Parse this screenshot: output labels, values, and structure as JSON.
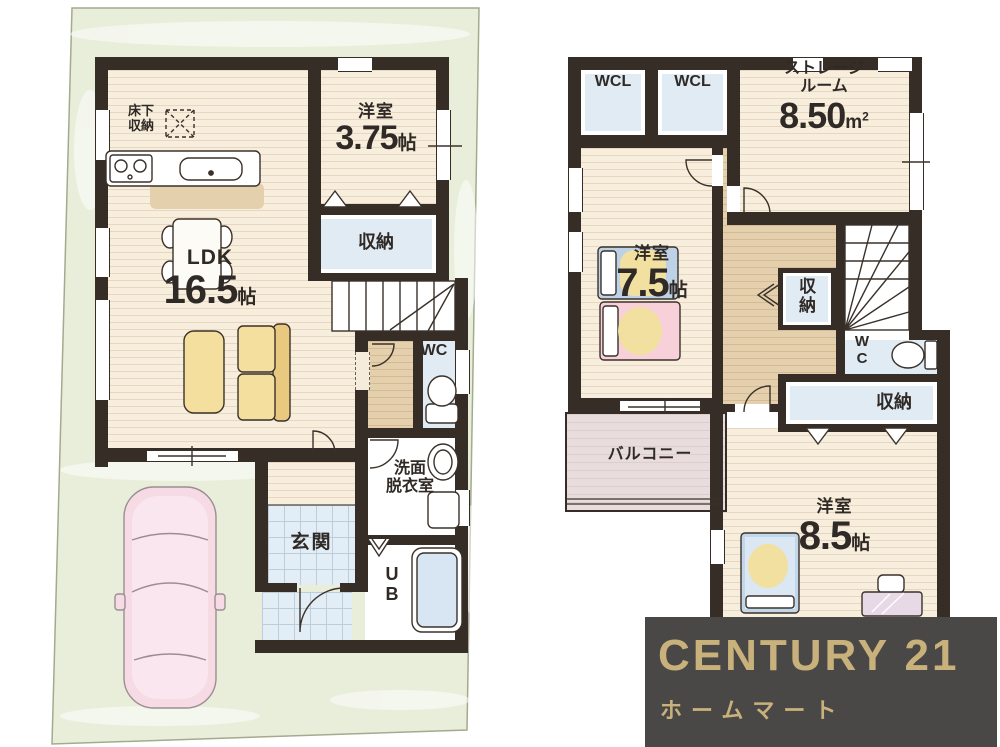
{
  "floor1": {
    "underfloor_storage": {
      "line1": "床下",
      "line2": "収納"
    },
    "western_room_375": {
      "name": "洋室",
      "size": "3.75",
      "unit": "帖"
    },
    "ldk": {
      "name": "LDK",
      "size": "16.5",
      "unit": "帖"
    },
    "closet": "収納",
    "wc": "WC",
    "washroom": {
      "line1": "洗面",
      "line2": "脱衣室"
    },
    "entrance": "玄関",
    "unit_bath": {
      "line1": "U",
      "line2": "B"
    }
  },
  "floor2": {
    "wcl_left": "WCL",
    "wcl_right": "WCL",
    "storage_room": {
      "line1": "ストレージ",
      "line2": "ルーム",
      "size": "8.50",
      "unit_base": "m",
      "unit_sup": "2"
    },
    "western_room_75": {
      "name": "洋室",
      "size": "7.5",
      "unit": "帖"
    },
    "closet_small": {
      "line1": "収",
      "line2": "納"
    },
    "wc": {
      "line1": "W",
      "line2": "C"
    },
    "closet_band": "収納",
    "western_room_85": {
      "name": "洋室",
      "size": "8.5",
      "unit": "帖"
    },
    "balcony": "バルコニー"
  },
  "logo": {
    "brand": "CENTURY 21",
    "store": "ホームマート"
  },
  "colors": {
    "wall": "#362d26",
    "floor_cream": "#f8eedd",
    "floor_tan": "#e5d0ad",
    "room_blue": "#e0ebf4",
    "tile_blue": "#e3edf5",
    "site_green": "#e9eedb",
    "balcony_mauve": "#e8dcdd",
    "sofa_yellow": "#f4df9e",
    "bed_pink": "#f8d0da",
    "bed_blue": "#bdd2e6",
    "car_pink": "#f6dae4",
    "logo_bg": "#4a4847",
    "logo_gold": "#c8b17b"
  }
}
